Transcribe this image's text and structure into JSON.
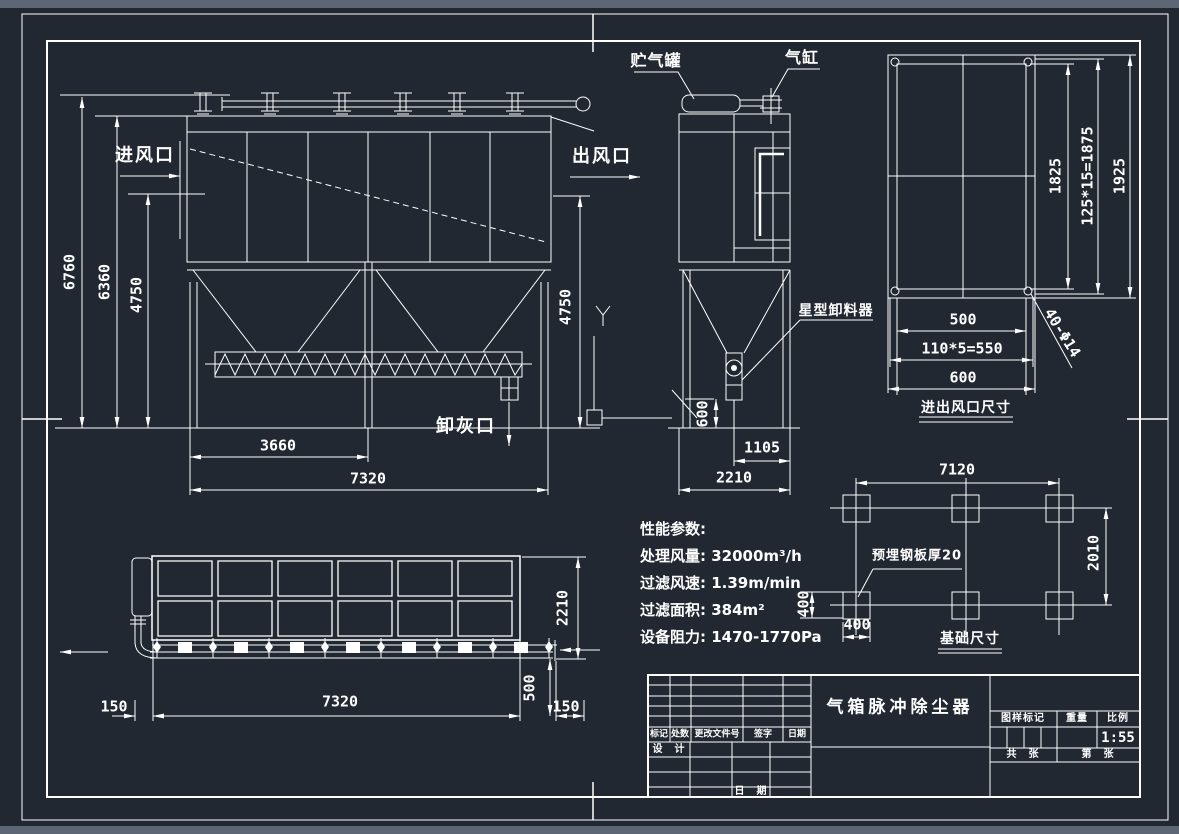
{
  "colors": {
    "background": "#212832",
    "line": "#ffffff",
    "chrome_bar": "#5c6674"
  },
  "labels": {
    "inlet": "进风口",
    "outlet": "出风口",
    "air_tank": "贮气罐",
    "gas_cylinder": "气缸",
    "star_unloader": "星型卸料器",
    "ash_outlet": "卸灰口",
    "embedded_plate": "预埋钢板厚20"
  },
  "view_titles": {
    "port_size": "进出风口尺寸",
    "foundation": "基础尺寸"
  },
  "dims": {
    "front": {
      "total_height": "6760",
      "body_height": "6360",
      "left_height": "4750",
      "right_height": "4750",
      "half_width": "3660",
      "width": "7320"
    },
    "side": {
      "hopper_outlet": "600",
      "half_depth": "1105",
      "depth": "2210"
    },
    "port": {
      "inner_height": "1825",
      "bolt_pitch_v": "125*15=1875",
      "outer_height": "1925",
      "inner_width": "500",
      "bolt_pitch_h": "110*5=550",
      "outer_width": "600",
      "bolt_holes": "40-Φ14"
    },
    "foundation": {
      "span": "7120",
      "depth": "2010",
      "pad_h": "400",
      "pad_w": "400"
    },
    "plan": {
      "margin_left": "150",
      "width": "7320",
      "offset": "500",
      "margin_right": "150",
      "depth": "2210"
    }
  },
  "specs": {
    "heading": "性能参数:",
    "items": [
      "处理风量: 32000m³/h",
      "过滤风速: 1.39m/min",
      "过滤面积: 384m²",
      "设备阻力: 1470-1770Pa"
    ]
  },
  "title_block": {
    "title": "气箱脉冲除尘器",
    "rev_headers": [
      "标记",
      "处数",
      "更改文件号",
      "签字",
      "日期"
    ],
    "design": "设　计",
    "date": "日　期",
    "stamp_header": "图样标记",
    "weight_header": "重量",
    "scale_header": "比例",
    "scale": "1:55",
    "sheet_total": "共　张",
    "sheet_number": "第　张"
  }
}
